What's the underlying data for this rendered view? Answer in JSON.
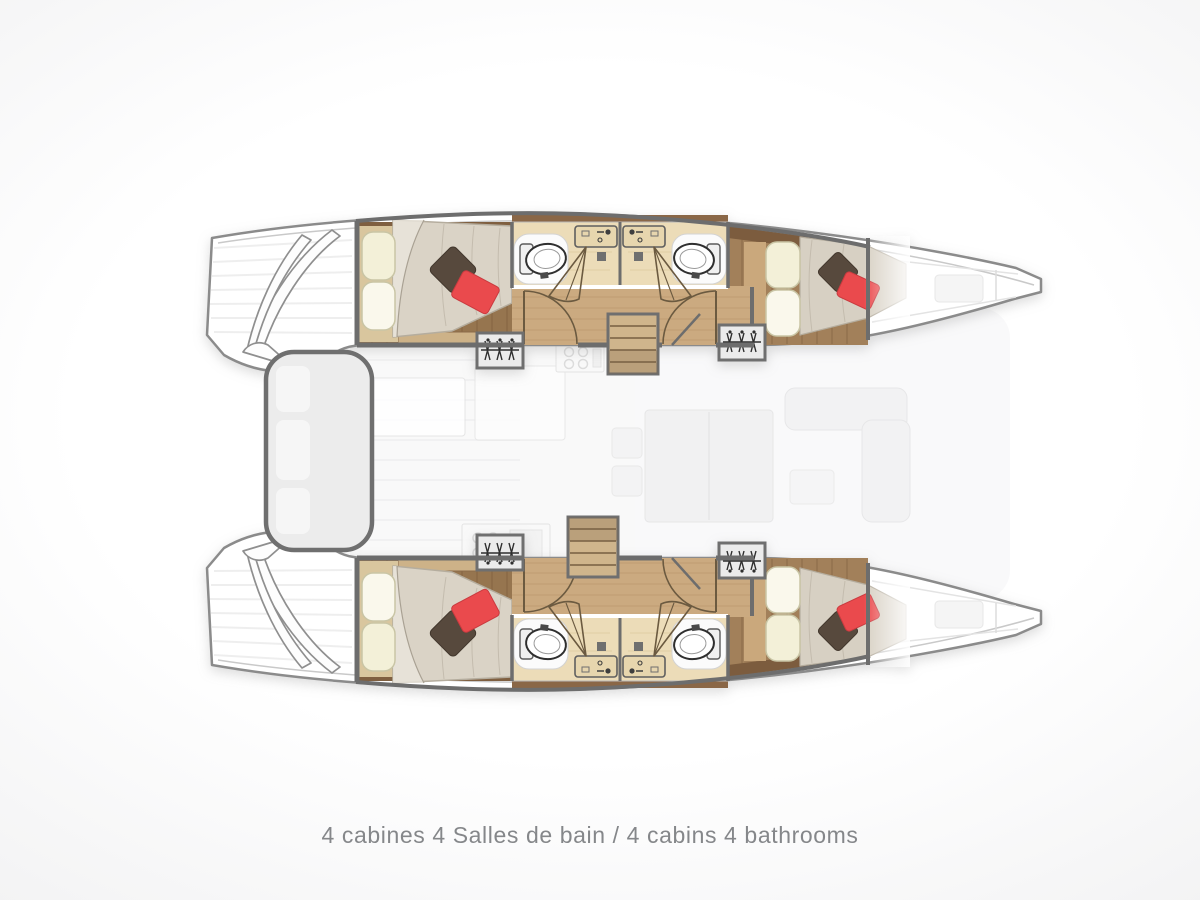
{
  "caption": {
    "text": "4 cabines 4 Salles de bain / 4 cabins 4 bathrooms"
  },
  "plan": {
    "type": "catamaran-deck-plan",
    "orientation": "bow-right",
    "hulls": [
      {
        "name": "port-hull",
        "rooms": [
          "aft-double-cabin",
          "aft-bathroom",
          "forward-bathroom",
          "forward-double-cabin",
          "bow-locker"
        ]
      },
      {
        "name": "starboard-hull",
        "rooms": [
          "aft-double-cabin",
          "aft-bathroom",
          "forward-bathroom",
          "forward-double-cabin",
          "bow-locker"
        ]
      }
    ],
    "center": [
      "aft-cockpit-bench",
      "salon-galley",
      "salon-table",
      "salon-sofa",
      "companionway-stairs-port",
      "companionway-stairs-starboard"
    ],
    "fixtures_per_bathroom": [
      "toilet",
      "sink-counter",
      "shower-door",
      "floor-drain"
    ],
    "fixtures_per_cabin": [
      "double-bed",
      "pillows",
      "decor-cushions",
      "wardrobe-with-hangers"
    ]
  },
  "icons": {
    "toilet-icon": "white oval bowl with tank",
    "sink-icon": "counter rectangle with faucet",
    "shower-door-icon": "pivoting wedge door",
    "door-swing-icon": "quarter-circle arc",
    "hanger-icon": "closet rod with hangers",
    "stairs-icon": "treads rectangle"
  },
  "colors": {
    "hull_outline": "#8b8b8b",
    "wall": "#6d6d6d",
    "cabin_wood_floor": "#96754f",
    "corridor_wood": "#cbaa80",
    "bathroom_floor": "#ecdcb8",
    "mattress": "#dad3c6",
    "pillow_cream": "#f3f0d8",
    "cushion_brown": "#57493d",
    "cushion_red": "#ea4a4d",
    "stairs_wood": "#cfb58c",
    "caption_text": "#85878a",
    "background": "#ffffff"
  }
}
